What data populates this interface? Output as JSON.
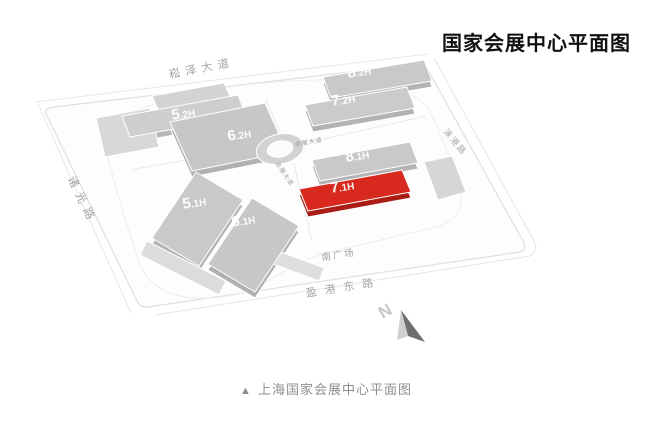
{
  "page": {
    "title": "国家会展中心平面图",
    "caption_marker": "▲",
    "caption": "上海国家会展中心平面图"
  },
  "map": {
    "halls": [
      {
        "name": "8.2H",
        "big": "8",
        "small": ".2H",
        "highlighted": false
      },
      {
        "name": "7.2H",
        "big": "7",
        "small": ".2H",
        "highlighted": false
      },
      {
        "name": "5.2H",
        "big": "5",
        "small": ".2H",
        "highlighted": false
      },
      {
        "name": "6.2H",
        "big": "6",
        "small": ".2H",
        "highlighted": false
      },
      {
        "name": "8.1H",
        "big": "8",
        "small": ".1H",
        "highlighted": false
      },
      {
        "name": "7.1H",
        "big": "7",
        "small": ".1H",
        "highlighted": true
      },
      {
        "name": "5.1H",
        "big": "5",
        "small": ".1H",
        "highlighted": false
      },
      {
        "name": "6.1H",
        "big": "6",
        "small": ".1H",
        "highlighted": false
      }
    ],
    "roads": {
      "songze_avenue": "崧泽大道",
      "zhuguang_road": "诸光路",
      "yinggang_east_road": "盈港东路",
      "laigang_road": "涞港路",
      "expo_avenue": "会展大道"
    },
    "labels": {
      "south_plaza": "南广场"
    },
    "compass": {
      "letter": "N"
    },
    "colors": {
      "highlight_hall": "#d8291f",
      "highlight_hall_side": "#aa1d15",
      "hall_gray": "#c9c9cb",
      "hall_gray_side": "#b3b3b5",
      "road_label_text": "#a5a5a7",
      "site_outline": "#dfdfe1"
    }
  }
}
